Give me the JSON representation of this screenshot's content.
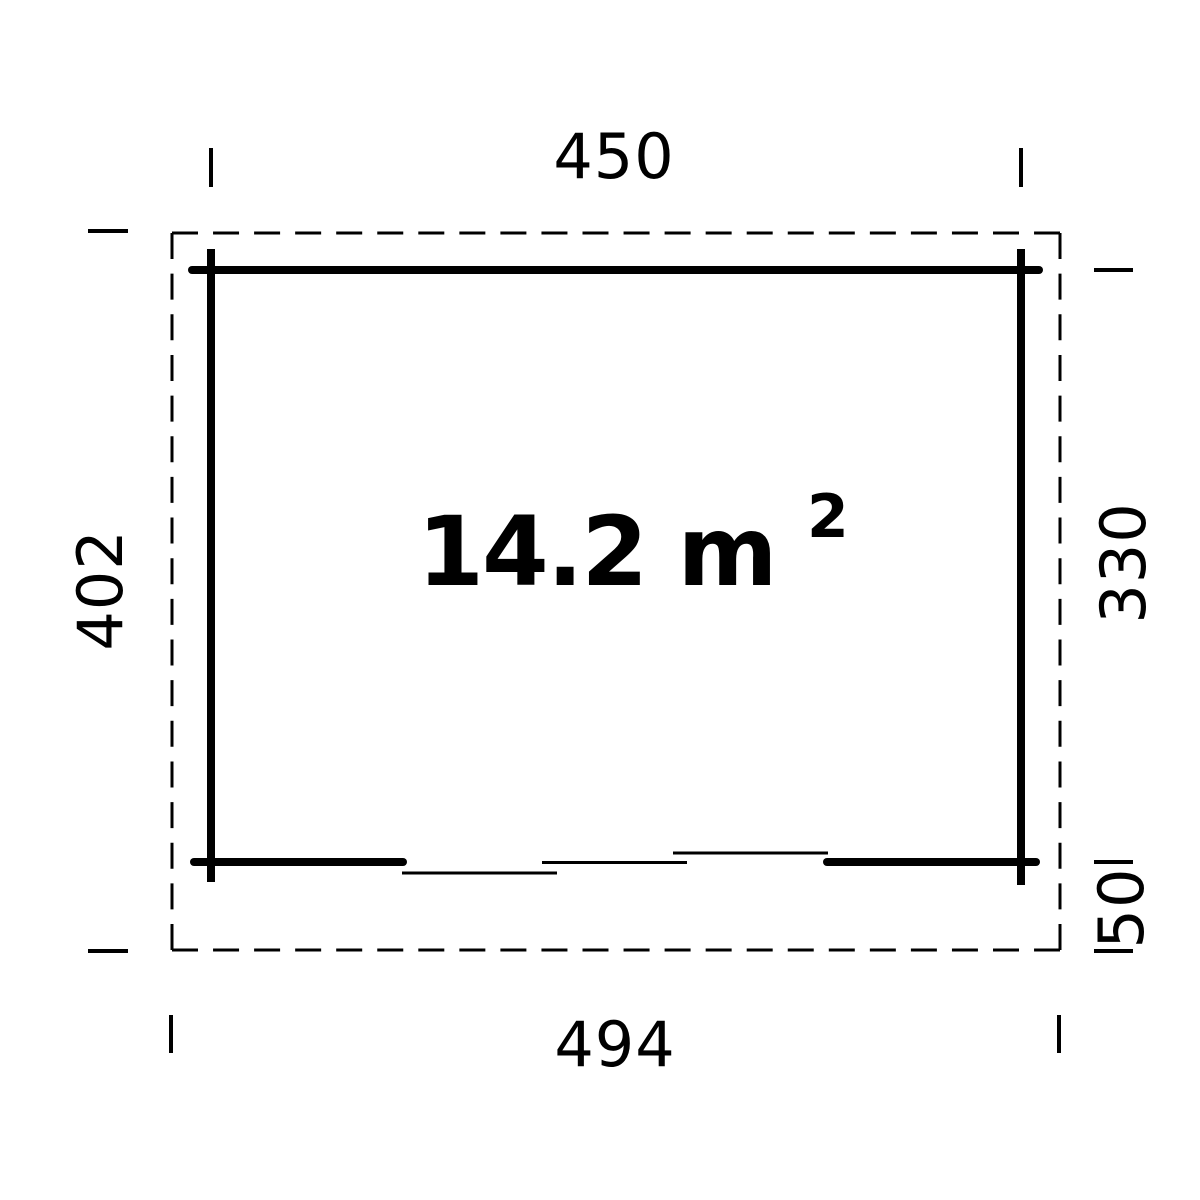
{
  "plan": {
    "area": {
      "text": "14.2 m",
      "superscript": "2"
    },
    "dimensions": {
      "top_width": "450",
      "left_depth": "402",
      "right_wall_depth": "330",
      "right_overhang": "50",
      "bottom_width": "494"
    },
    "colors": {
      "line": "#000000",
      "background": "#ffffff"
    }
  }
}
